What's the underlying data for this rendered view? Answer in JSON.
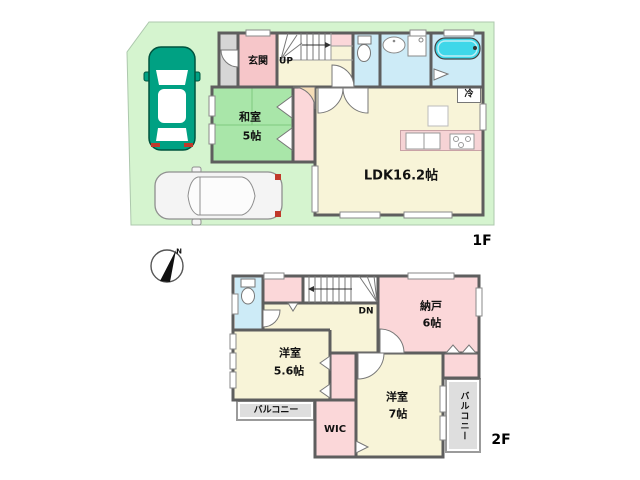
{
  "compass": {
    "north": "N"
  },
  "floor1": {
    "label": "1F",
    "genkan": "玄関",
    "stairs_up": "UP",
    "washitsu_name": "和室",
    "washitsu_size": "5帖",
    "ldk": "LDK16.2帖",
    "refrigerator": "冷"
  },
  "floor2": {
    "label": "2F",
    "stairs_down": "DN",
    "nando_name": "納戸",
    "nando_size": "6帖",
    "yoshitsu_a_name": "洋室",
    "yoshitsu_a_size": "5.6帖",
    "yoshitsu_b_name": "洋室",
    "yoshitsu_b_size": "7帖",
    "balcony_left": "バルコニー",
    "balcony_right": "バルコニー",
    "wic": "WIC"
  },
  "colors": {
    "lot_green": "#d5f4cf",
    "tatami_green": "#a9e6a9",
    "room_pink": "#fbd7d9",
    "genkan_pink": "#f6c6c9",
    "room_cream": "#f8f4d8",
    "water_blue": "#cdebf7",
    "tub_cyan": "#3fd7e9",
    "balcony_gray": "#dedede",
    "wall_gray": "#5e5e5e",
    "car_teal": "#00a183"
  }
}
